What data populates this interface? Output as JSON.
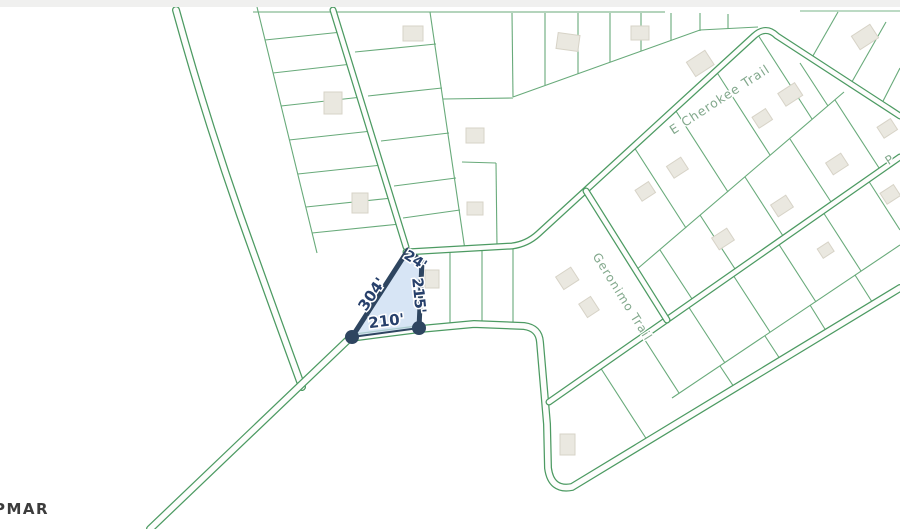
{
  "map": {
    "watermark": "PMAR",
    "road_labels": {
      "cherokee": "E Cherokee Trail",
      "geronimo": "Geronimo Trail",
      "partial_right": "P"
    },
    "highlight_parcel": {
      "dim_top": "24'",
      "dim_right": "215'",
      "dim_hypotenuse": "304'",
      "dim_bottom": "210'"
    },
    "colors": {
      "road_green": "#4c9a62",
      "parcel_line_green": "#68aa7a",
      "road_label_green": "#82a88c",
      "highlight_fill": "#c9dcf2",
      "highlight_stroke": "#2e4560",
      "dimension_text": "#27406b",
      "building_fill": "#eae8e0",
      "building_stroke": "#d7d3c7",
      "watermark_text": "#3c3c3c",
      "top_bar": "#f0f0ef"
    }
  }
}
